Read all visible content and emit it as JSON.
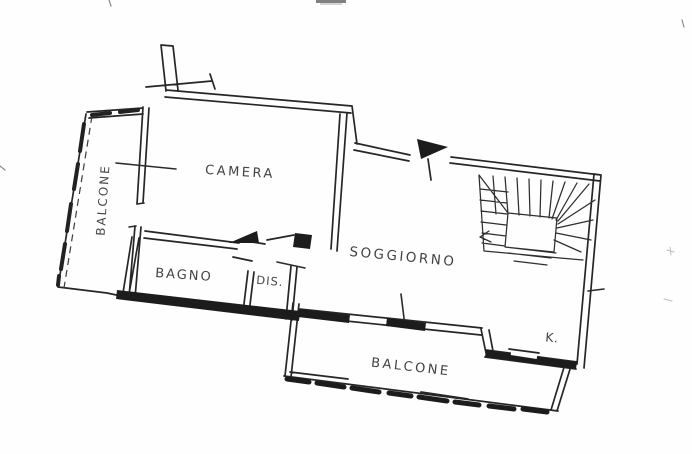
{
  "colors": {
    "paper": "#fefefe",
    "ink": "#262626"
  },
  "floor_plan": {
    "rooms": {
      "balcone_left": {
        "label": "BALCONE"
      },
      "camera": {
        "label": "CAMERA"
      },
      "bagno": {
        "label": "BAGNO"
      },
      "dis": {
        "label": "DIS."
      },
      "soggiorno": {
        "label": "SOGGIORNO"
      },
      "kitchen": {
        "label": "K."
      },
      "balcone_bottom": {
        "label": "BALCONE"
      }
    }
  }
}
